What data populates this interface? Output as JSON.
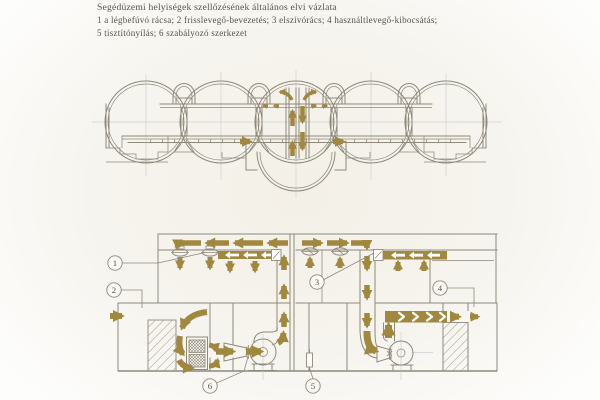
{
  "caption": {
    "title": "Segédüzemi helyiségek szellőzésének általános elvi vázlata",
    "legend_line_1": "1 a légbefúvó rácsa; 2 frisslevegő-bevezetés; 3 elszívórács; 4 használtlevegő-kibocsátás;",
    "legend_line_2": "5 tisztítónyílás; 6 szabályozó szerkezet"
  },
  "callouts": {
    "c1": "1",
    "c2": "2",
    "c3": "3",
    "c4": "4",
    "c5": "5",
    "c6": "6"
  },
  "colors": {
    "accent": "#a1883f",
    "line": "#8f897c",
    "faint": "#ccd1d6",
    "text": "#56524a",
    "paper": "#f4f1e9"
  }
}
